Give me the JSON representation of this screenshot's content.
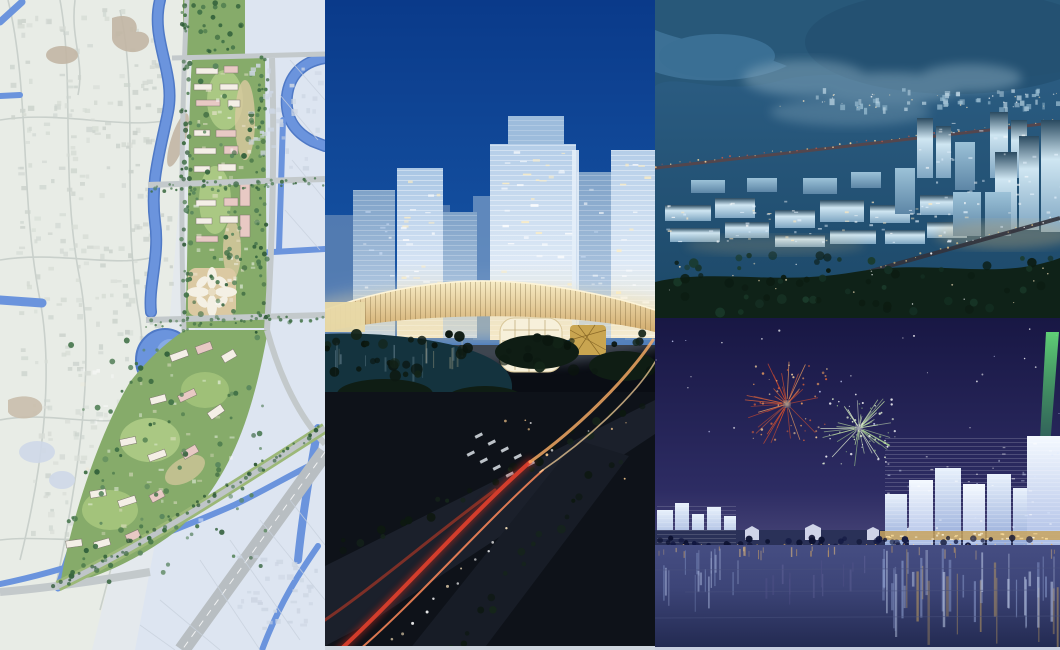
{
  "collage": {
    "name": "urban-planning-presentation-collage",
    "description": "Four-panel collage of urban design imagery: a riverside master-plan map, a night CBD tower rendering, an aerial night city rendering, and a waterfront fireworks rendering",
    "panels": [
      {
        "id": "masterplan-map",
        "label": "Riverside master plan site map",
        "position": "left",
        "type": "site-plan-map",
        "features": [
          "meandering canal",
          "green landscape corridor",
          "residential building blocks",
          "road network",
          "pond",
          "tree-lined boulevards"
        ],
        "palette": {
          "paper_left": "#e8ece6",
          "paper_right": "#dde5f1",
          "water": "#6b94dd",
          "water_edge": "#4f79c6",
          "greenway": "#86ab6a",
          "lawn": "#b3cf8a",
          "trees": "#3c6b42",
          "road": "#c3c9cb",
          "plaza_tan": "#dbc9a2",
          "building_white": "#f4efe6",
          "building_pink": "#e8c9c4"
        }
      },
      {
        "id": "cbd-night",
        "label": "CBD glass towers night rendering with curved lit podium and street intersection",
        "position": "center",
        "type": "architectural-night-rendering",
        "features": [
          "deep blue night sky",
          "glass office towers",
          "curved illuminated podium ribbon",
          "lake with trees",
          "road intersection with crosswalk",
          "red tail-light streaks"
        ],
        "palette": {
          "sky_top": "#0a3a8a",
          "sky_bottom": "#1d57a6",
          "glass_cool": "#bcd4ec",
          "glass_warm": "#f2e7c8",
          "podium_gold": "#e6cf96",
          "lake": "#14333e",
          "ground": "#0e1219",
          "taillight_red": "#e0402e",
          "streetlight_amber": "#ffb066"
        }
      },
      {
        "id": "aerial-night",
        "label": "Aerial night view of illuminated business park and river",
        "position": "top-right",
        "type": "aerial-night-rendering",
        "features": [
          "steel-blue dusk haze",
          "river bend",
          "distant city band",
          "lit mid-rise clusters",
          "tall towers on right",
          "lit bridge road",
          "dark tree foreground"
        ],
        "palette": {
          "sky_top": "#2f6289",
          "sky_bottom": "#1c4868",
          "river": "#3e7398",
          "lit_facade": "#cfe6f2",
          "facade_shadow": "#7fa6c2",
          "road_lights": "#e8b87a",
          "foreground_trees": "#0f2218"
        }
      },
      {
        "id": "waterfront-fireworks",
        "label": "Night waterfront skyline with fireworks and green searchlight",
        "position": "bottom-right",
        "type": "waterfront-night-rendering",
        "features": [
          "indigo night sky with stars",
          "red-orange firework",
          "green-white firework",
          "green searchlight beam",
          "illuminated glass skyline",
          "golden podium lights",
          "water reflections"
        ],
        "palette": {
          "sky_top": "#181744",
          "sky_horizon": "#474577",
          "firework_red": "#e06438",
          "firework_green": "#cfe8b8",
          "beam_green": "#54c86a",
          "tower_glow": "#e8f1fc",
          "podium_gold": "#c9a45e",
          "water": "#3d4578",
          "water_deep": "#222950"
        }
      }
    ]
  }
}
